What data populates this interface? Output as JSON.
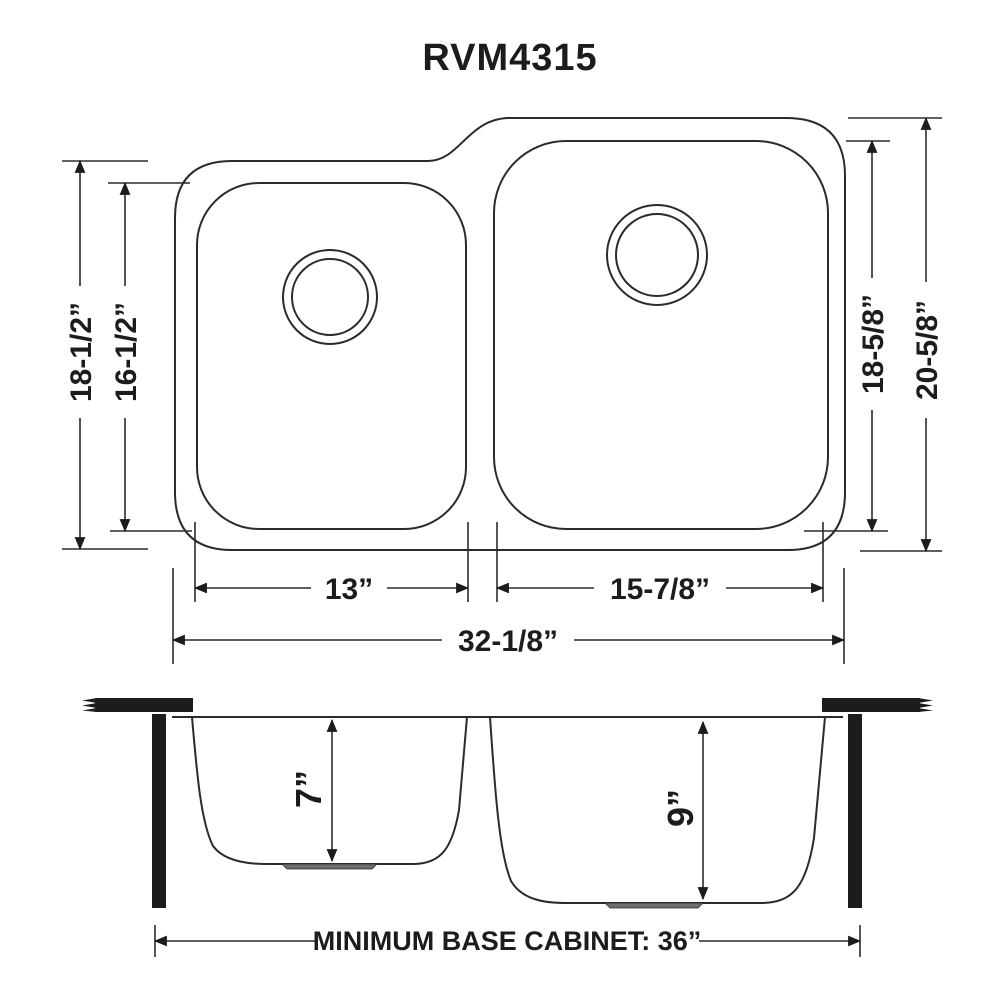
{
  "title": "RVM4315",
  "colors": {
    "line": "#2b2b2b",
    "text": "#1c1c1c",
    "background": "#ffffff",
    "counter_fill": "#1c1c1c",
    "drain_fill": "#6e6e6e"
  },
  "top_view": {
    "dimensions": {
      "left_bowl_outer_height": "18-1/2”",
      "left_bowl_inner_height": "16-1/2”",
      "right_bowl_inner_height": "18-5/8”",
      "right_bowl_outer_height": "20-5/8”",
      "left_bowl_width": "13”",
      "right_bowl_width": "15-7/8”",
      "overall_width": "32-1/8”"
    }
  },
  "section_view": {
    "dimensions": {
      "left_bowl_depth": "7”",
      "right_bowl_depth": "9”",
      "base_cabinet": "MINIMUM BASE CABINET: 36”"
    }
  }
}
